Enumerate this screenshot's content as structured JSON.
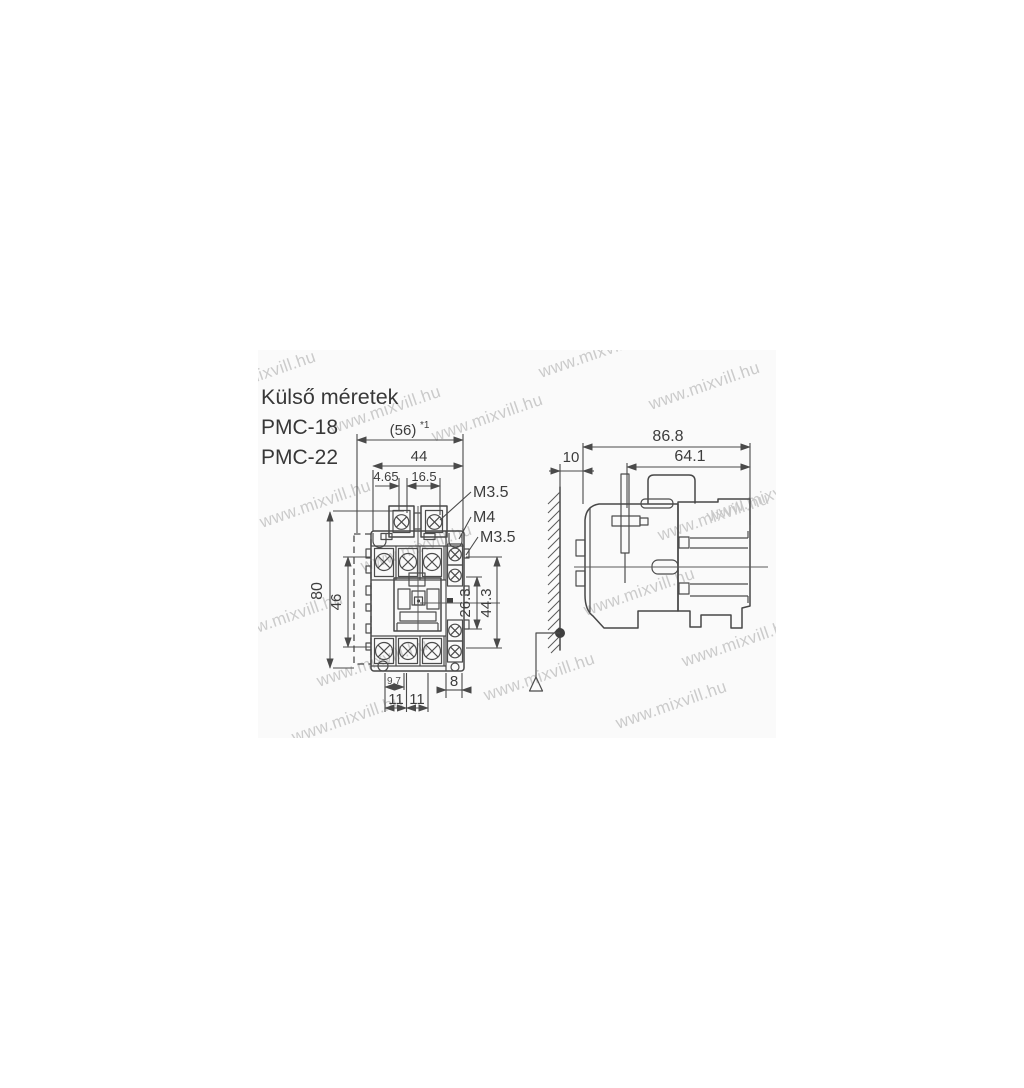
{
  "title": "Külső méretek",
  "models": [
    "PMC-18",
    "PMC-22"
  ],
  "watermark": {
    "text": "www.mixvill.hu",
    "color": "#c6c6c6"
  },
  "front_view": {
    "dims": {
      "width_total": "(56)",
      "width_total_note": "*1",
      "width_inner": "44",
      "coil_offset": "4.65",
      "coil_pitch": "16.5",
      "height_total": "80",
      "height_inner": "46",
      "aux_span_inner": "26.3",
      "aux_span_outer": "44.3",
      "foot_offset": "9.7",
      "hole_pitch_left": "11",
      "hole_pitch_right": "11",
      "aux_width": "8"
    },
    "labels": {
      "coil_terminal_screw": "M3.5",
      "mounting_screw": "M4",
      "aux_terminal_screw": "M3.5"
    }
  },
  "side_view": {
    "dims": {
      "depth_total": "86.8",
      "depth_body": "64.1",
      "wall_clearance": "10"
    }
  },
  "colors": {
    "line": "#474747",
    "text": "#3a3a3a",
    "watermark": "#c6c6c6",
    "background": "#ffffff"
  }
}
